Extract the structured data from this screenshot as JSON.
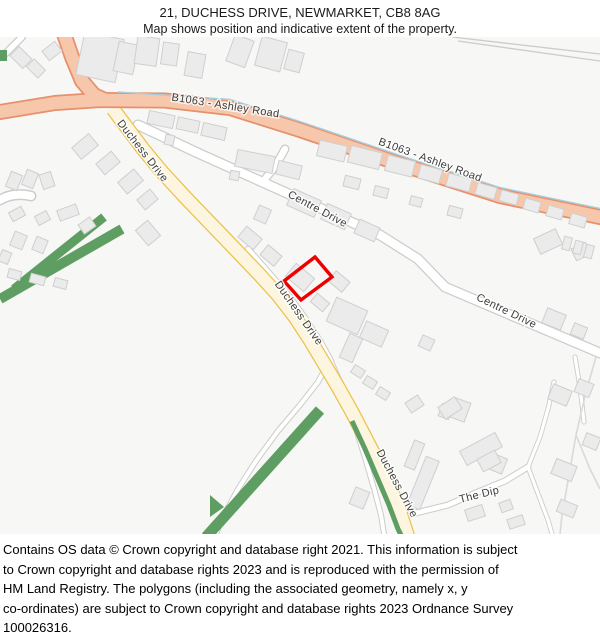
{
  "header": {
    "title": "21, DUCHESS DRIVE, NEWMARKET, CB8 8AG",
    "subtitle": "Map shows position and indicative extent of the property."
  },
  "map": {
    "labels": {
      "ashley_road_west": "B1063 - Ashley Road",
      "ashley_road_east": "B1063 - Ashley Road",
      "duchess_drive_north": "Duchess Drive",
      "duchess_drive_mid": "Duchess Drive",
      "duchess_drive_south": "Duchess Drive",
      "centre_drive_west": "Centre Drive",
      "centre_drive_east": "Centre Drive",
      "the_dip": "The Dip"
    },
    "colors": {
      "b_road_fill": "#f6c7ab",
      "b_road_casing": "#e8906c",
      "minor_road_fill": "#fcf5e0",
      "minor_road_casing": "#edc14a",
      "white_road_fill": "#ffffff",
      "road_casing": "#cccccc",
      "building_fill": "#ebebeb",
      "building_stroke": "#cfcfcf",
      "green_area": "#5f9e62",
      "water_line": "#a8cddd",
      "property_outline": "#ee0000",
      "label_text": "#3d3d3d",
      "map_background": "#f7f7f5"
    }
  },
  "footer": {
    "lines": [
      "Contains OS data © Crown copyright and database right 2021. This information is subject",
      "to Crown copyright and database rights 2023 and is reproduced with the permission of",
      "HM Land Registry. The polygons (including the associated geometry, namely x, y",
      "co-ordinates) are subject to Crown copyright and database rights 2023 Ordnance Survey",
      "100026316."
    ]
  }
}
